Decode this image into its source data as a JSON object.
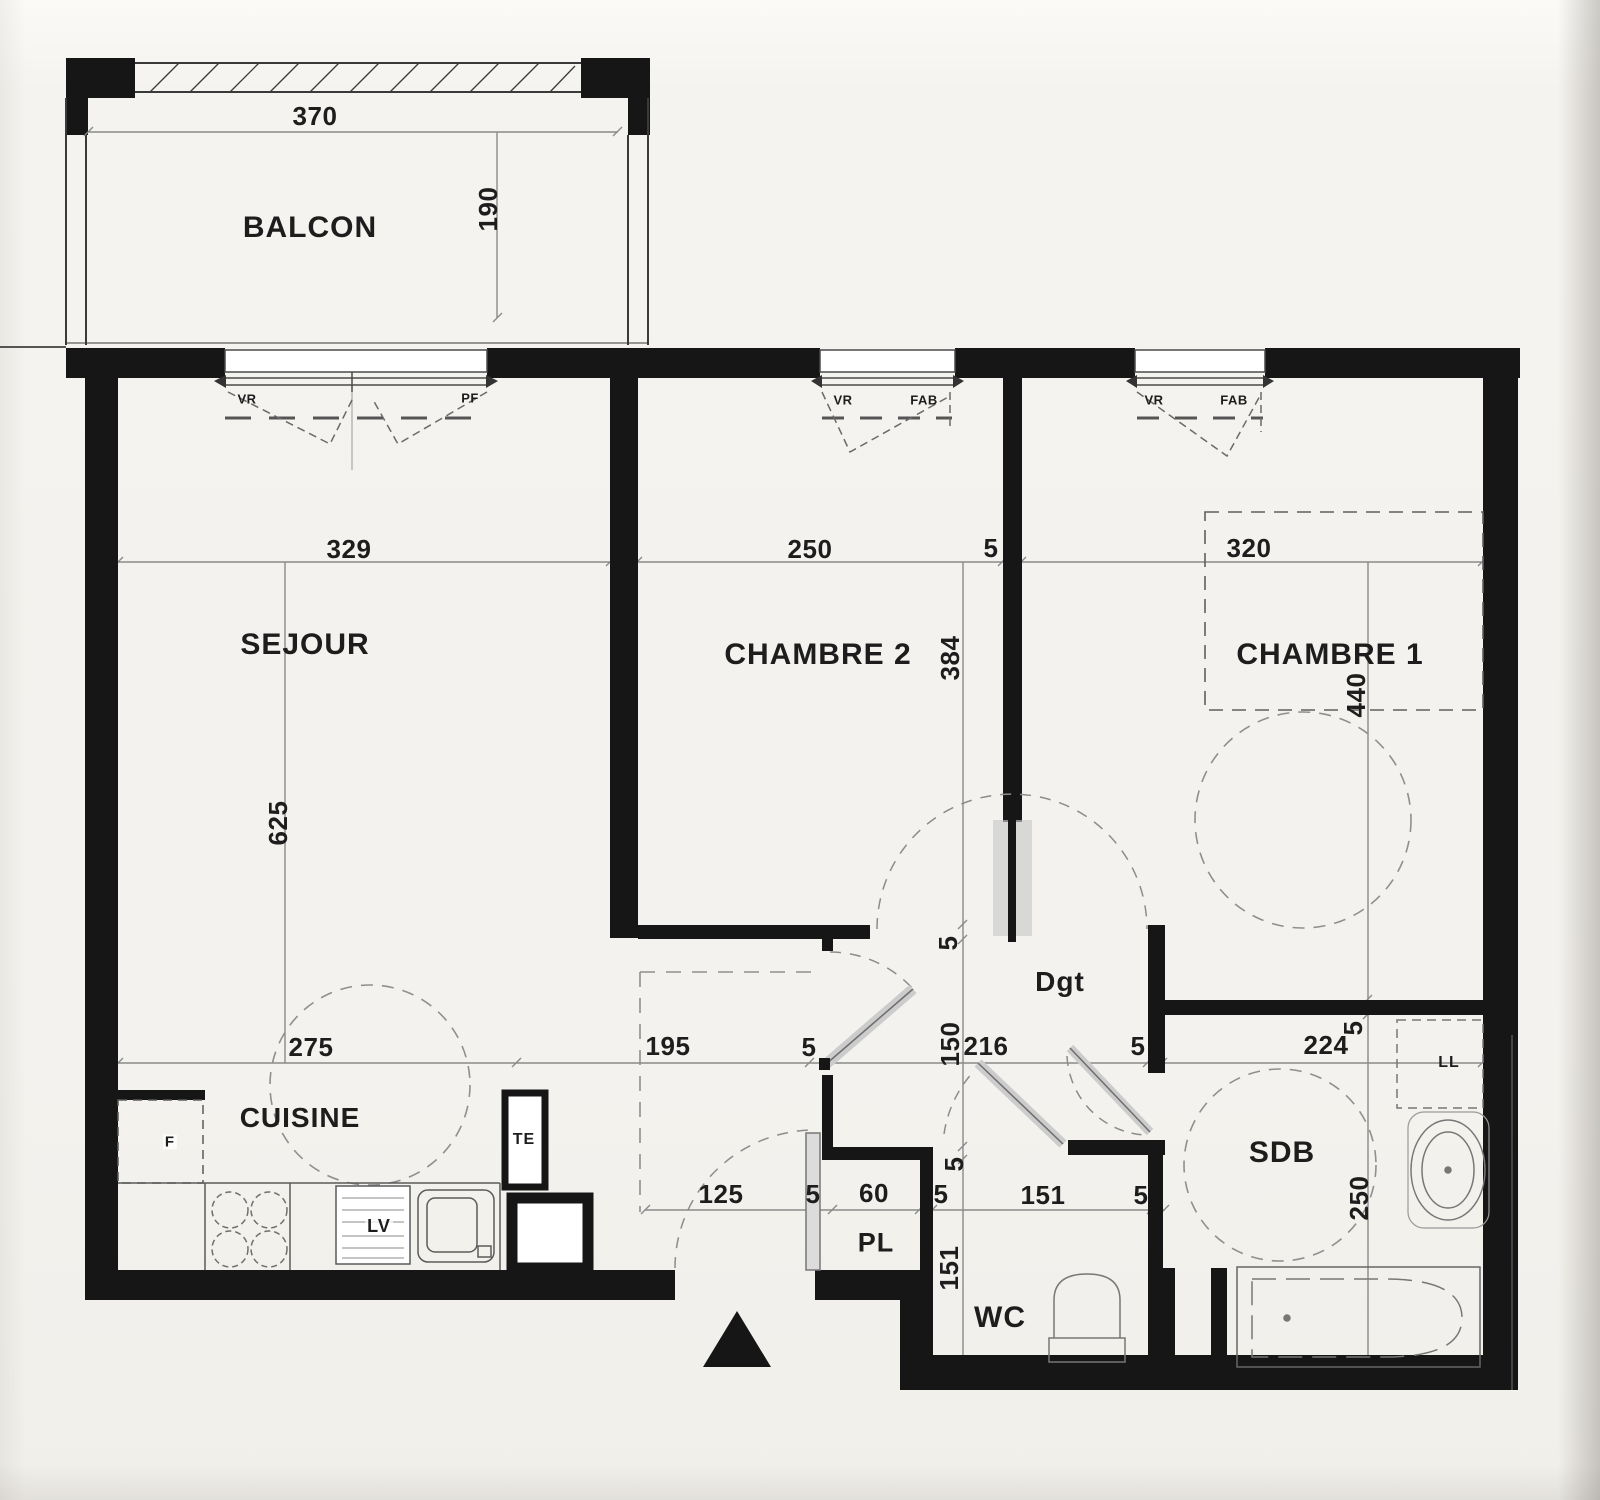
{
  "plan_title": "Floor plan (French apartment)",
  "rooms": {
    "balcon": "BALCON",
    "sejour": "SEJOUR",
    "chambre2": "CHAMBRE 2",
    "chambre1": "CHAMBRE 1",
    "cuisine": "CUISINE",
    "degagement": "Dgt",
    "sdb": "SDB",
    "wc": "WC",
    "placard": "PL"
  },
  "fixtures": {
    "fridge": "F",
    "technical_duct": "TE",
    "dishwasher": "LV",
    "washing_machine": "LL"
  },
  "window_tags": {
    "sejour_vr": "VR",
    "sejour_pf": "PF",
    "chambre2_vr": "VR",
    "chambre2_fab": "FAB",
    "chambre1_vr": "VR",
    "chambre1_fab": "FAB"
  },
  "dims": {
    "balcony_w": "370",
    "balcony_d": "190",
    "sejour_w": "329",
    "sejour_d": "625",
    "chambre2_w": "250",
    "chambre2_d": "384",
    "wall_ch2_ch1": "5",
    "chambre1_w": "320",
    "chambre1_d": "440",
    "ch1_floor_wall": "5",
    "cuisine_w": "275",
    "entry_w": "195",
    "entry_wall": "5",
    "hall_w": "216",
    "hall_d": "150",
    "hall_wall_top": "5",
    "hall_wall_bottom": "5",
    "hall_sdb_wall": "5",
    "sdb_w": "224",
    "sdb_d": "250",
    "door_w": "125",
    "door_side_wall": "5",
    "pl_w": "60",
    "pl_side_wall": "5",
    "wc_w": "151",
    "wc_side_wall": "5",
    "wc_d": "151"
  }
}
